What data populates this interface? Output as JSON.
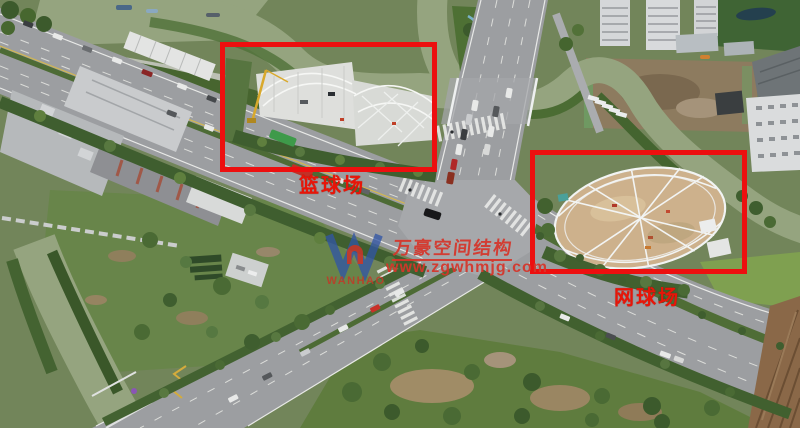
{
  "image": {
    "kind": "aerial-drone-photograph",
    "subject": "City road intersection beside a river; two sports-court steel structures under construction are highlighted with red boxes"
  },
  "annotations": {
    "basketball_court_label": "篮球场",
    "tennis_court_label": "网球场"
  },
  "watermark": {
    "company_name": "万豪空间结构",
    "website": "www.zgwhmjg.com",
    "logo_text": "WANHAO"
  },
  "colors": {
    "annotation_red": "#ed0f0f",
    "label_red": "#e81508",
    "watermark_red": "#d6352a",
    "logo_blue": "#3156a6",
    "water_green": "#95a47f",
    "vegetation_green": "#5d7a40",
    "road_gray": "#9c9ea1",
    "sand_tan": "#cdb18c"
  }
}
